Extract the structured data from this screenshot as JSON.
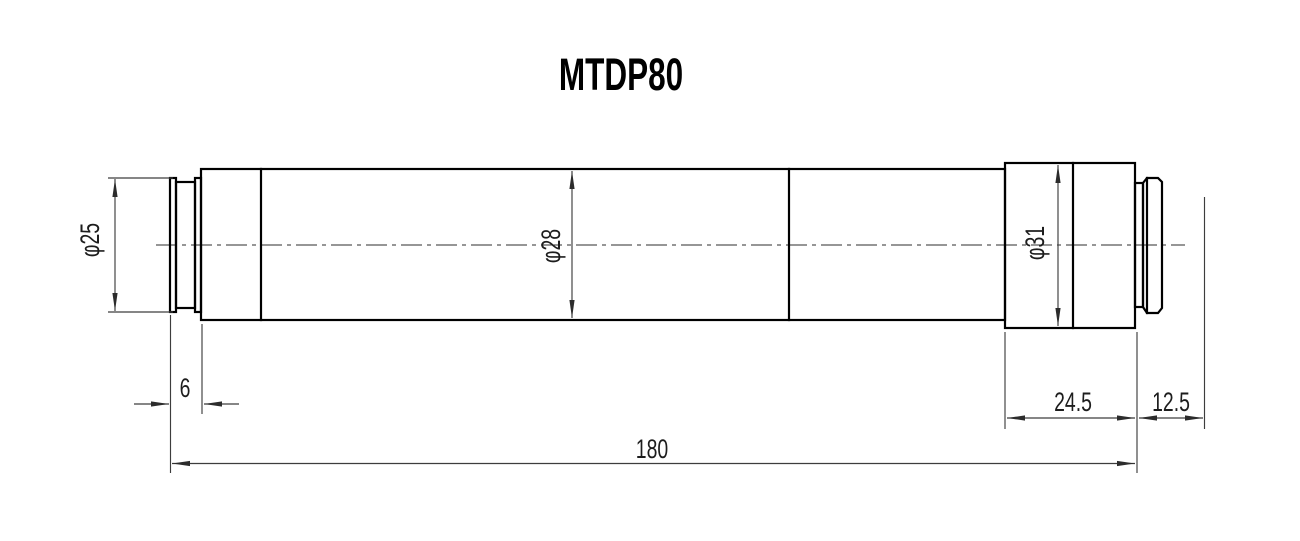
{
  "drawing": {
    "title": "MTDP80",
    "type_note": "technical dimension drawing of cylindrical lens barrel",
    "dimensions": {
      "diameter_left": "φ25",
      "diameter_body": "φ28",
      "diameter_right": "φ31",
      "length_left_cap": "6",
      "length_right_section": "24.5",
      "length_flange_offset": "12.5",
      "length_total": "180"
    },
    "colors": {
      "outline": "#000000",
      "dimension": "#3d3d3d",
      "background": "#ffffff"
    }
  }
}
